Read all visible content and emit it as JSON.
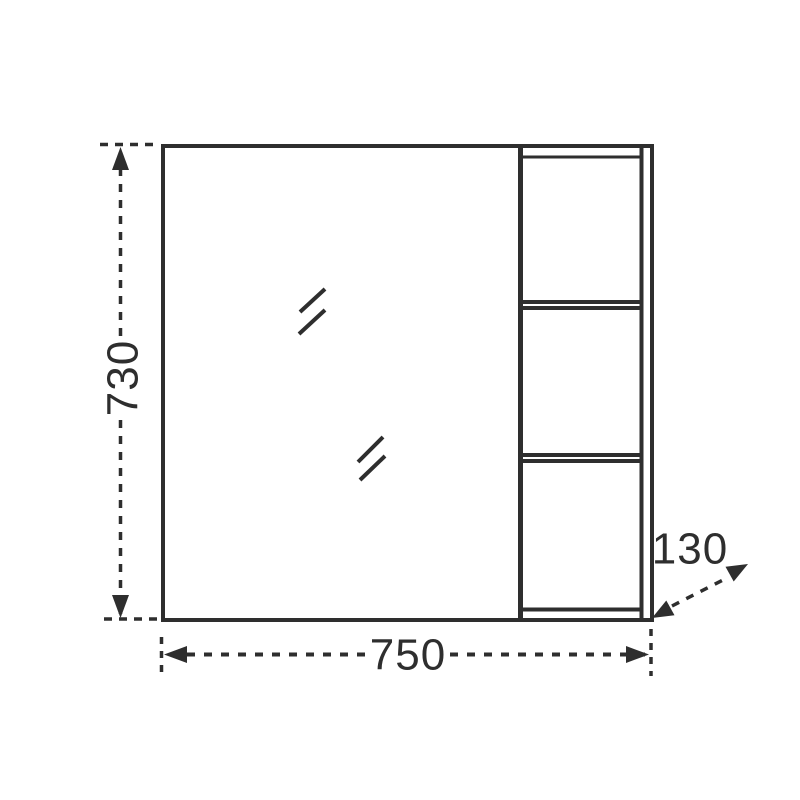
{
  "page": {
    "background_color": "#ffffff"
  },
  "drawing": {
    "type": "furniture-technical-drawing",
    "subject": "mirror cabinet front elevation with side shelf column",
    "line_color": "#2e2e2e",
    "shelf_compartments": 3,
    "mirror_marks": 2,
    "dimensions": {
      "height": {
        "label": "730"
      },
      "width": {
        "label": "750"
      },
      "depth": {
        "label": "130"
      }
    }
  }
}
